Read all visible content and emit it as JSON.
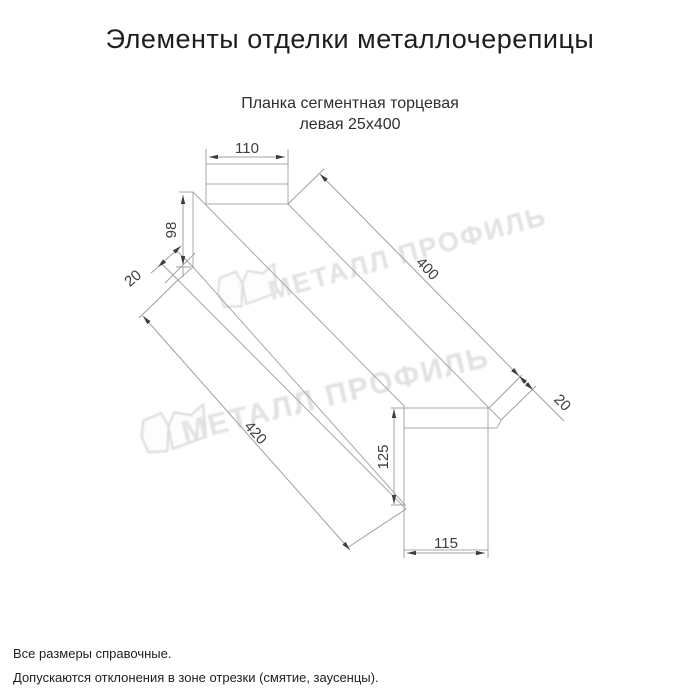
{
  "title": "Элементы отделки металлочерепицы",
  "subtitle": {
    "line1": "Планка сегментная торцевая",
    "line2": "левая 25х400"
  },
  "drawing": {
    "name": "Планка сегментная торцевая левая 25х400",
    "dimensions": {
      "top_flange_width": "110",
      "left_end_height": "98",
      "left_fold": "20",
      "top_length": "400",
      "right_fold": "20",
      "bottom_length": "420",
      "right_end_height": "125",
      "right_end_width": "115"
    }
  },
  "watermark": {
    "text": "МЕТАЛЛ ПРОФИЛЬ",
    "color": "#e2e2e2"
  },
  "footer": {
    "line1": "Все размеры справочные.",
    "line2": "Допускаются отклонения в зоне отрезки (смятие, заусенцы)."
  },
  "colors": {
    "line": "#a8a8a8",
    "dimension_text": "#3d3d3d",
    "title_text": "#1e1e1e",
    "watermark": "#e2e2e2"
  }
}
